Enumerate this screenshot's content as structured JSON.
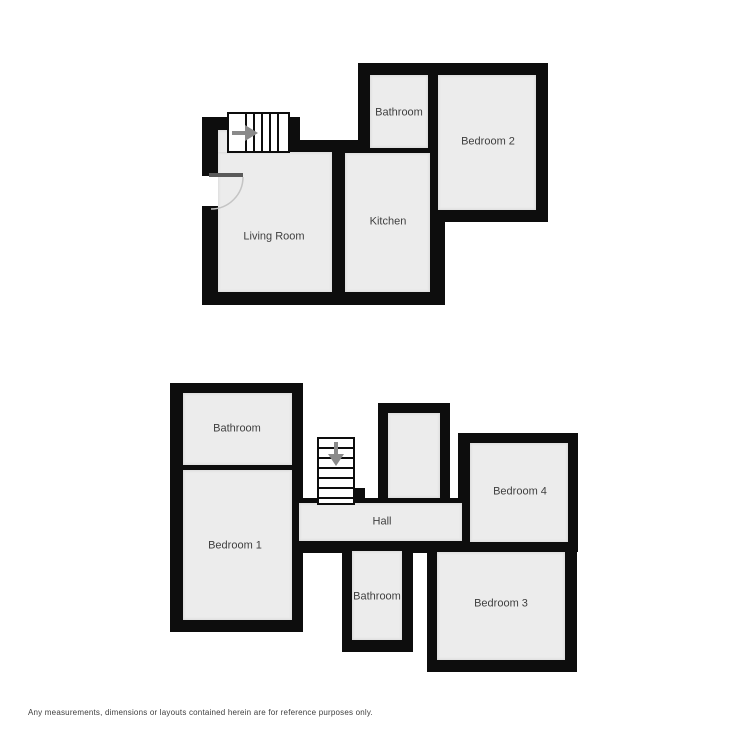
{
  "rooms": {
    "upper": {
      "bathroom": "Bathroom",
      "bedroom_2": "Bedroom 2",
      "kitchen": "Kitchen",
      "living_room": "Living Room"
    },
    "lower": {
      "bathroom_top": "Bathroom",
      "bedroom_1": "Bedroom 1",
      "hall": "Hall",
      "bedroom_4": "Bedroom 4",
      "bathroom_middle": "Bathroom",
      "bedroom_3": "Bedroom 3"
    }
  },
  "icons": {
    "stairs_up_arrow": "right-arrow",
    "stairs_down_arrow": "down-arrow"
  },
  "footer": {
    "disclaimer": "Any measurements, dimensions or layouts contained herein are for reference purposes only."
  },
  "colors": {
    "wall": "#0d0d0d",
    "room_fill": "#ececec",
    "label": "#3f3f3f",
    "arrow": "#8a8a8a",
    "door": "#5a5a5a",
    "arc": "#c4c4c4",
    "background": "#ffffff"
  }
}
